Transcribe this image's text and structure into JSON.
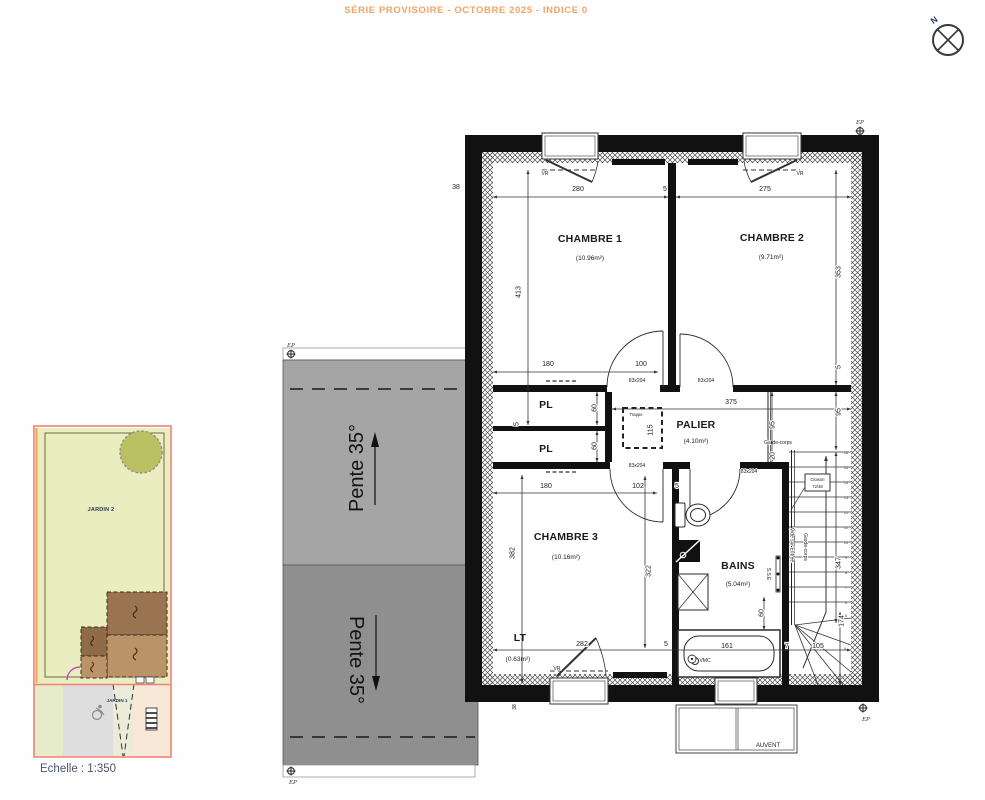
{
  "colors": {
    "accent_orange": "#f2a366",
    "wall_black": "#111111",
    "roof_upper_gray": "#a5a5a5",
    "roof_lower_gray": "#8f8f8f",
    "garden_green": "#eaedbf",
    "tree_olive": "#b9c162",
    "boundary_red": "#ef8276",
    "boundary_orange": "#f0a24e",
    "building_dark_brown": "#9a7450",
    "building_light_brown": "#ba9368",
    "scale_text": "#4a5568"
  },
  "header": {
    "title": "SÉRIE PROVISOIRE - OCTOBRE 2025 - INDICE 0"
  },
  "compass": {
    "north": "N"
  },
  "site_plan": {
    "jardin2": "JARDIN 2",
    "jardin1": "JARDIN 1",
    "scale": "Echelle : 1:350"
  },
  "roof": {
    "pente_upper": "Pente 35°",
    "pente_lower": "Pente 35°"
  },
  "floor_plan": {
    "rooms": {
      "chambre1": {
        "name": "CHAMBRE 1",
        "area": "(10.96m²)"
      },
      "chambre2": {
        "name": "CHAMBRE 2",
        "area": "(9.71m²)"
      },
      "chambre3": {
        "name": "CHAMBRE 3",
        "area": "(10.16m²)"
      },
      "palier": {
        "name": "PALIER",
        "area": "(4.10m²)"
      },
      "bains": {
        "name": "BAINS",
        "area": "(5.04m²)"
      },
      "lt": {
        "name": "LT",
        "area": "(0.63m²)"
      },
      "placard": "PL"
    },
    "dims": {
      "d280": "280",
      "d275": "275",
      "d5": "5",
      "d38": "38",
      "d413": "413",
      "d353": "353",
      "d180": "180",
      "d100": "100",
      "d375": "375",
      "d95": "95",
      "d20": "20",
      "d115": "115",
      "d60": "60",
      "d102": "102",
      "d382": "382",
      "d322": "322",
      "d282": "282",
      "d161": "161",
      "d7": "7",
      "d105": "105",
      "d347": "347",
      "d174": "174"
    },
    "labels": {
      "door": "83x204",
      "vr": "VR",
      "trappe": "Trappe",
      "vmc": "VMC",
      "sse": "S.S.E",
      "garde_corps": "Garde-corps",
      "vide_sur_entree": "Vide sur Entrée",
      "cloison1": "Cloison",
      "cloison2": "72/48",
      "ep": "EP",
      "auvent": "AUVENT"
    },
    "stairs": {
      "numbers": [
        "1",
        "2",
        "3",
        "4",
        "5",
        "6",
        "7",
        "8",
        "9",
        "10",
        "11",
        "12",
        "13",
        "14",
        "15",
        "16"
      ]
    }
  }
}
